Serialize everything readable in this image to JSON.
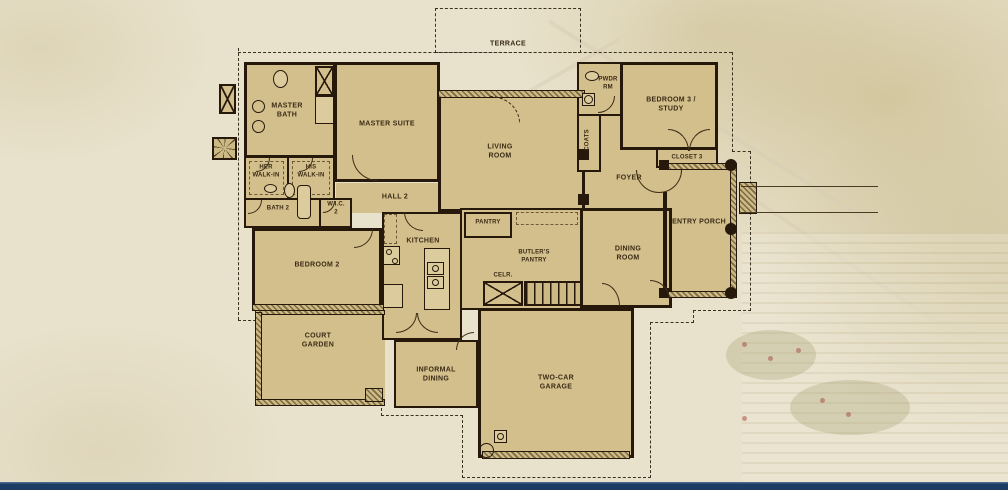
{
  "colors": {
    "background": "#e8e1cb",
    "plan_fill": "#d3bf8c",
    "wall": "#26190c",
    "label_text": "#3a2b15",
    "dash_line": "#3a3020",
    "hatch": "#7b6a45",
    "footer_bar": "#1d3c63",
    "footer_bar_highlight": "#46688e"
  },
  "labels": {
    "terrace": "TERRACE",
    "master_bath": "MASTER\nBATH",
    "master_suite": "MASTER SUITE",
    "her_walkin": "HER\nWALK-IN",
    "his_walkin": "HIS\nWALK-IN",
    "bath_2": "BATH 2",
    "wic_2": "W.I.C.\n2",
    "hall_2": "HALL 2",
    "bedroom_2": "BEDROOM 2",
    "living_room": "LIVING\nROOM",
    "pwdr_rm": "PWDR\nRM",
    "coats": "COATS",
    "bedroom_3": "BEDROOM 3 /\nSTUDY",
    "closet_3": "CLOSET 3",
    "foyer": "FOYER",
    "entry_porch": "ENTRY PORCH",
    "pantry": "PANTRY",
    "kitchen": "KITCHEN",
    "butlers_pantry": "BUTLER'S\nPANTRY",
    "cellar": "CELR.",
    "dining_room": "DINING\nROOM",
    "informal_dining": "INFORMAL\nDINING",
    "court_garden": "COURT\nGARDEN",
    "two_car_garage": "TWO-CAR\nGARAGE"
  },
  "icons": {
    "elevator_box": "x-in-box",
    "closet_box": "x-in-box",
    "hvac_unit": "x-in-box",
    "condenser_fan": "starburst-in-box",
    "stairs": "striped-treads",
    "porch_column": "filled-circle"
  }
}
